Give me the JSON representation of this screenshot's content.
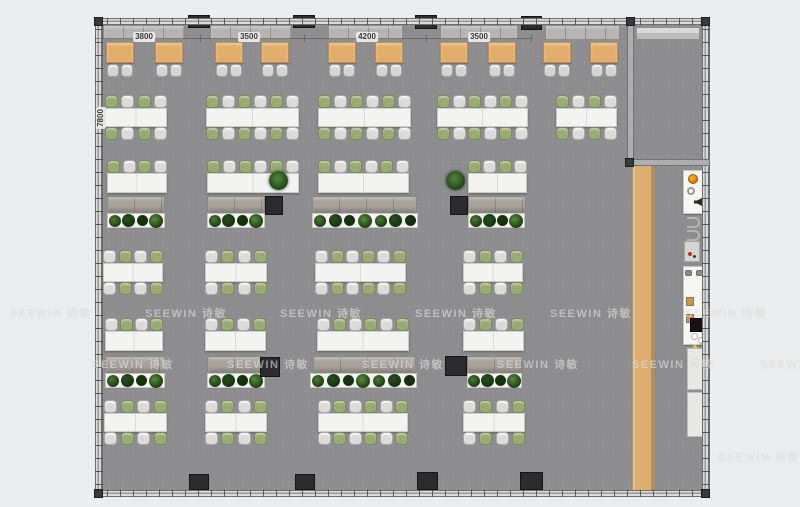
{
  "watermark": {
    "text": "SEEWIN 诗敏"
  },
  "colors": {
    "page_bg": "#ecedee",
    "floor": "#8d8d8f",
    "wood_strip": "#dcae72",
    "booth_table": "#e2ae6c",
    "chair_green": "#9aaa74",
    "chair_white": "#dbdbd9",
    "desk_white": "#f3f3f1",
    "cabinet": "#a7a29b",
    "pillar": "#2c2c2e",
    "accent_orange": "#d97b08",
    "watermark_text": "rgba(250,250,248,0.48)"
  },
  "floorplan": {
    "dims": {
      "top": [
        {
          "label": "3800",
          "cx": 144
        },
        {
          "label": "3500",
          "cx": 249
        },
        {
          "label": "4200",
          "cx": 367
        },
        {
          "label": "3500",
          "cx": 479
        }
      ],
      "left": {
        "label": "7800"
      },
      "line": {
        "x1": 95,
        "x2": 531,
        "y": 38,
        "ticks": [
          95,
          200,
          304,
          426,
          531
        ]
      }
    },
    "floor": {
      "x": 101,
      "y": 24,
      "w": 602,
      "h": 467
    },
    "walls": [
      {
        "side": "top",
        "x": 95,
        "y": 18,
        "w": 615,
        "h": 7
      },
      {
        "side": "bottom",
        "x": 95,
        "y": 490,
        "w": 615,
        "h": 7
      },
      {
        "side": "left",
        "x": 95,
        "y": 18,
        "w": 8,
        "h": 479
      },
      {
        "side": "right",
        "x": 702,
        "y": 18,
        "w": 8,
        "h": 479
      }
    ],
    "partitions": [
      {
        "x": 627,
        "y": 18,
        "w": 7,
        "h": 148
      },
      {
        "x": 627,
        "y": 159,
        "w": 83,
        "h": 7
      }
    ],
    "room": {
      "credenza": {
        "x": 636,
        "y": 27,
        "w": 64,
        "h": 13
      }
    },
    "corners": [
      {
        "x": 94,
        "y": 17
      },
      {
        "x": 94,
        "y": 489
      },
      {
        "x": 701,
        "y": 489
      },
      {
        "x": 701,
        "y": 17
      },
      {
        "x": 626,
        "y": 17
      },
      {
        "x": 625,
        "y": 158
      }
    ],
    "wood_strip": {
      "x": 632,
      "y": 166,
      "w": 22,
      "h": 324
    },
    "benches": [
      {
        "x": 103,
        "w": 82
      },
      {
        "x": 210,
        "w": 82
      },
      {
        "x": 328,
        "w": 75
      },
      {
        "x": 440,
        "w": 78
      },
      {
        "x": 545,
        "w": 75
      }
    ],
    "bench_y": 25,
    "bench_h": 15,
    "booth_tables": {
      "y": 42,
      "h": 21,
      "w": 28,
      "xs": [
        106,
        155,
        215,
        261,
        328,
        375,
        440,
        488,
        543,
        590
      ]
    },
    "rows": [
      {
        "name": "row-b",
        "y": 95,
        "sides": "both",
        "first": "green",
        "clusters": [
          [
            105,
            62,
            4
          ],
          [
            206,
            93,
            6
          ],
          [
            318,
            93,
            6
          ],
          [
            437,
            91,
            6
          ],
          [
            556,
            61,
            4
          ]
        ]
      },
      {
        "name": "row-c",
        "y": 160,
        "sides": "top",
        "first": "green",
        "clusters": [
          [
            107,
            60,
            4
          ],
          [
            207,
            92,
            6
          ],
          [
            318,
            91,
            6
          ],
          [
            468,
            59,
            4
          ]
        ]
      },
      {
        "name": "row-d",
        "y": 250,
        "sides": "both",
        "first": "white",
        "clusters": [
          [
            103,
            60,
            4
          ],
          [
            205,
            62,
            4
          ],
          [
            315,
            91,
            6
          ],
          [
            463,
            60,
            4
          ]
        ]
      },
      {
        "name": "row-e",
        "y": 318,
        "sides": "top",
        "first": "white",
        "clusters": [
          [
            105,
            58,
            4
          ],
          [
            205,
            61,
            4
          ],
          [
            317,
            92,
            6
          ],
          [
            463,
            61,
            4
          ]
        ]
      },
      {
        "name": "row-f",
        "y": 400,
        "sides": "both",
        "first": "white",
        "clusters": [
          [
            104,
            63,
            4
          ],
          [
            205,
            62,
            4
          ],
          [
            318,
            90,
            6
          ],
          [
            463,
            62,
            4
          ]
        ]
      }
    ],
    "cabinets": [
      {
        "y": 196,
        "items": [
          [
            107,
            58
          ],
          [
            207,
            58
          ],
          [
            312,
            105
          ],
          [
            468,
            58
          ]
        ]
      },
      {
        "y": 356,
        "items": [
          [
            105,
            60
          ],
          [
            207,
            58
          ],
          [
            313,
            103
          ],
          [
            467,
            56
          ]
        ]
      }
    ],
    "cabinet_h": 17,
    "planters": [
      {
        "y": 213,
        "items": [
          [
            107,
            58,
            4
          ],
          [
            207,
            58,
            4
          ],
          [
            312,
            106,
            7
          ],
          [
            468,
            57,
            4
          ]
        ]
      },
      {
        "y": 373,
        "items": [
          [
            105,
            60,
            4
          ],
          [
            207,
            58,
            4
          ],
          [
            310,
            107,
            7
          ],
          [
            467,
            55,
            4
          ]
        ]
      }
    ],
    "planter_h": 15,
    "plant_colors": [
      "#4a7c34",
      "#27501f",
      "#17360f",
      "#588d3b"
    ],
    "pot_plants": [
      {
        "x": 269,
        "y": 171
      },
      {
        "x": 446,
        "y": 171
      }
    ],
    "pillars": [
      [
        188,
        15,
        22,
        13
      ],
      [
        293,
        15,
        22,
        13
      ],
      [
        415,
        15,
        22,
        14
      ],
      [
        521,
        16,
        21,
        14
      ],
      [
        189,
        474,
        20,
        16
      ],
      [
        295,
        474,
        20,
        16
      ],
      [
        417,
        472,
        21,
        18
      ],
      [
        520,
        472,
        23,
        18
      ],
      [
        95,
        192,
        8,
        21
      ],
      [
        95,
        356,
        8,
        21
      ],
      [
        265,
        196,
        18,
        19
      ],
      [
        450,
        196,
        18,
        19
      ],
      [
        260,
        357,
        20,
        20
      ],
      [
        445,
        356,
        22,
        20
      ]
    ],
    "fixtures": [
      [
        "unit-white",
        683,
        170,
        24,
        44
      ],
      [
        "dot-orange",
        688,
        174,
        10,
        10
      ],
      [
        "ring",
        687,
        187,
        8,
        8
      ],
      [
        "glyph-dark",
        694,
        198,
        8,
        8
      ],
      [
        "arc",
        687,
        217,
        13,
        11
      ],
      [
        "arc",
        687,
        230,
        13,
        11
      ],
      [
        "appliance",
        684,
        241,
        16,
        21
      ],
      [
        "dot-red",
        688,
        252,
        4,
        4
      ],
      [
        "dot-dark",
        693,
        255,
        3,
        3
      ],
      [
        "unit-white",
        683,
        266,
        24,
        79
      ],
      [
        "stool",
        685,
        270,
        7,
        6
      ],
      [
        "stool",
        696,
        270,
        7,
        6
      ],
      [
        "wood-item",
        686,
        297,
        8,
        9
      ],
      [
        "wood-item",
        686,
        314,
        8,
        9
      ],
      [
        "box-black",
        690,
        318,
        15,
        14
      ],
      [
        "circle-white",
        691,
        333,
        7,
        7
      ],
      [
        "circle-white",
        698,
        337,
        7,
        7
      ],
      [
        "dot-yellow",
        693,
        345,
        4,
        4
      ],
      [
        "panel",
        687,
        348,
        19,
        42
      ],
      [
        "panel",
        687,
        392,
        18,
        45
      ]
    ],
    "watermarks": [
      {
        "x": 10,
        "y": 305
      },
      {
        "x": 145,
        "y": 305
      },
      {
        "x": 280,
        "y": 305
      },
      {
        "x": 415,
        "y": 305
      },
      {
        "x": 550,
        "y": 305
      },
      {
        "x": 685,
        "y": 305
      },
      {
        "x": 92,
        "y": 356
      },
      {
        "x": 227,
        "y": 356
      },
      {
        "x": 362,
        "y": 356
      },
      {
        "x": 497,
        "y": 356
      },
      {
        "x": 632,
        "y": 356
      },
      {
        "x": 760,
        "y": 356
      },
      {
        "x": 718,
        "y": 449
      }
    ]
  }
}
